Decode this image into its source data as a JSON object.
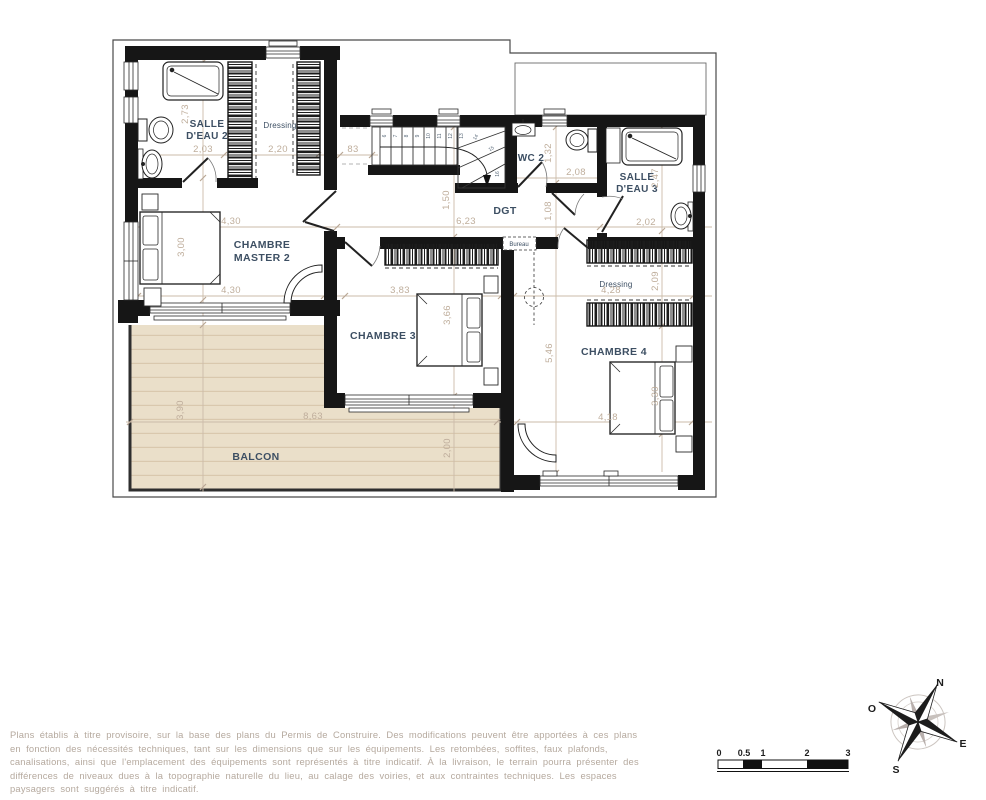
{
  "plan": {
    "rooms": {
      "salle_eau_2": {
        "line1": "SALLE",
        "line2": "D'EAU 2"
      },
      "dressing_1": {
        "label": "Dressing"
      },
      "wc_2": {
        "label": "WC 2"
      },
      "salle_eau_3": {
        "line1": "SALLE",
        "line2": "D'EAU 3"
      },
      "dgt": {
        "label": "DGT"
      },
      "chambre_master_2": {
        "line1": "CHAMBRE",
        "line2": "MASTER 2"
      },
      "chambre_3": {
        "label": "CHAMBRE 3"
      },
      "chambre_4": {
        "label": "CHAMBRE 4"
      },
      "bureau": {
        "label": "Bureau"
      },
      "dressing_2": {
        "label": "Dressing"
      },
      "balcon": {
        "label": "BALCON"
      }
    },
    "dimensions": {
      "sde2_height": "2,73",
      "sde2_width": "2,03",
      "dressing1_width": "2,20",
      "stair_gap": "83",
      "master_width_top": "4,30",
      "master_height": "3,00",
      "master_width_bottom": "4,30",
      "stair_width": "1,50",
      "dgt_width": "6,23",
      "wc2_height": "1,32",
      "wc2_width": "2,08",
      "dgt_height": "1,08",
      "sde3_height": "2,47",
      "sde3_width": "2,02",
      "ch3_width": "3,83",
      "ch3_height": "3,66",
      "ch4_height": "5,46",
      "dressing2_height": "2,09",
      "dressing2_width": "4,28",
      "ch4_bed_width": "3,30",
      "ch4_width_bottom": "4,18",
      "balcon_width": "8,63",
      "balcon_height_left": "3,90",
      "balcon_depth": "2,00"
    },
    "stair_steps": [
      "6",
      "7",
      "8",
      "9",
      "10",
      "11",
      "12",
      "13",
      "14",
      "15",
      "16"
    ]
  },
  "scale_bar": {
    "labels": [
      "0",
      "0.5",
      "1",
      "2",
      "3"
    ]
  },
  "compass": {
    "north": "N",
    "west": "O",
    "east": "E",
    "south": "S"
  },
  "footer": {
    "lines": [
      "Plans établis à titre provisoire, sur la base des plans du Permis de Construire. Des modifications peuvent être apportées à ces plans",
      "en fonction des nécessités techniques, tant sur les dimensions que sur les équipements. Les retombées, soffites, faux plafonds,",
      "canalisations, ainsi que l'emplacement des équipements sont représentés à titre indicatif. À la livraison, le terrain pourra présenter des",
      "différences de niveaux dues à la topographie naturelle du lieu, au calage des voiries, et aux contraintes techniques. Les espaces",
      "paysagers sont suggérés à titre indicatif."
    ]
  },
  "colors": {
    "wall": "#161616",
    "dimension_text": "#bfae9c",
    "room_label": "#3d4f63",
    "balcony_fill": "#eadfc9",
    "balcony_stripe": "#d9c8ad"
  }
}
